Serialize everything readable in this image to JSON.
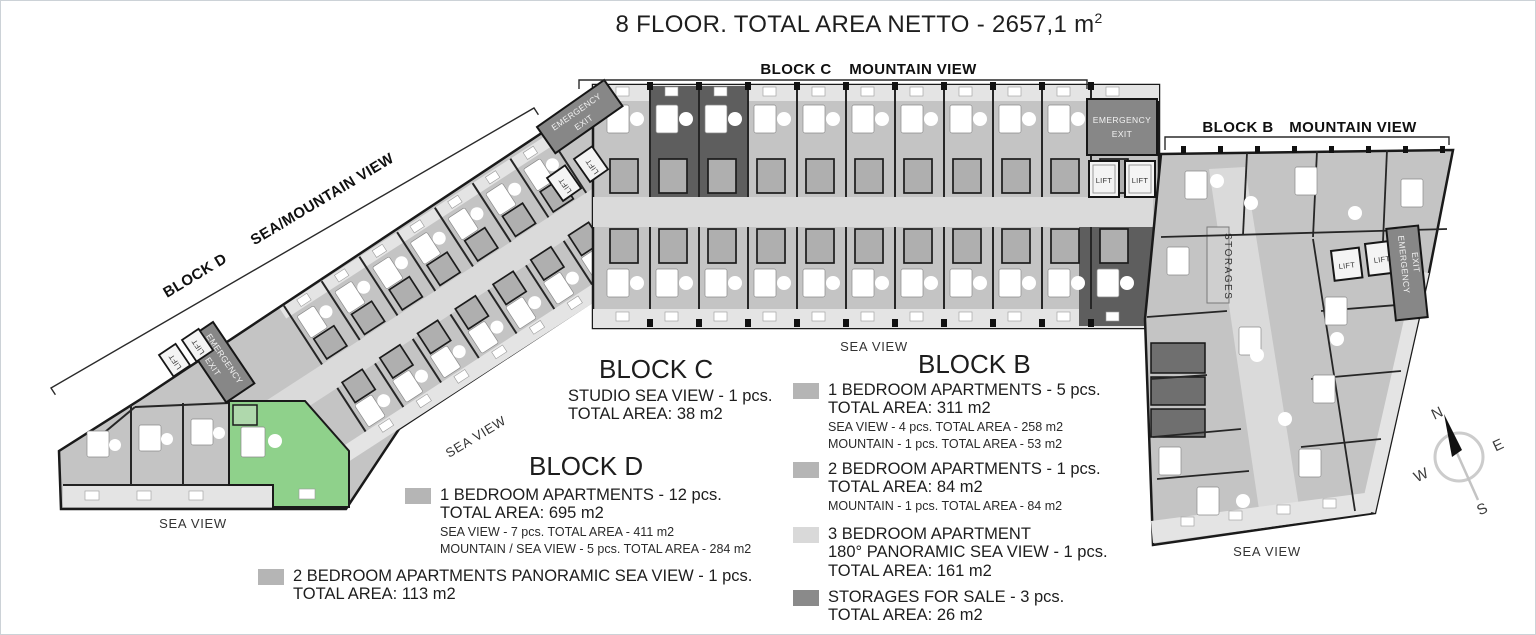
{
  "title": {
    "text": "8 FLOOR. TOTAL AREA NETTO - 2657,1 m",
    "sup": "2"
  },
  "banners": {
    "c": {
      "block": "BLOCK C",
      "view": "MOUNTAIN VIEW"
    },
    "b": {
      "block": "BLOCK B",
      "view": "MOUNTAIN VIEW"
    },
    "d": {
      "block": "BLOCK D",
      "view": "SEA/MOUNTAIN VIEW"
    }
  },
  "plan_labels": {
    "sea_view": "SEA VIEW",
    "storages": "STORAGES",
    "lift": "LIFT",
    "emergency_line1": "EMERGENCY",
    "emergency_line2": "EXIT"
  },
  "compass": {
    "n": "N",
    "e": "E",
    "s": "S",
    "w": "W"
  },
  "legends": {
    "block_c": {
      "heading": "BLOCK C",
      "line1": "STUDIO SEA VIEW - 1 pcs.",
      "line2": "TOTAL AREA: 38 m2"
    },
    "block_d": {
      "heading": "BLOCK D",
      "items": [
        {
          "swatch": "#b5b5b5",
          "main": [
            "1 BEDROOM APARTMENTS - 12 pcs.",
            "TOTAL AREA: 695 m2"
          ],
          "sub": [
            "SEA VIEW - 7 pcs. TOTAL AREA - 411 m2",
            "MOUNTAIN / SEA VIEW - 5 pcs. TOTAL AREA - 284 m2"
          ]
        },
        {
          "swatch": "#b5b5b5",
          "main": [
            "2 BEDROOM APARTMENTS PANORAMIC SEA VIEW - 1 pcs.",
            "TOTAL AREA: 113 m2"
          ],
          "sub": []
        }
      ]
    },
    "block_b": {
      "heading": "BLOCK B",
      "items": [
        {
          "swatch": "#b5b5b5",
          "main": [
            "1 BEDROOM APARTMENTS - 5 pcs.",
            "TOTAL AREA: 311 m2"
          ],
          "sub": [
            "SEA VIEW - 4 pcs. TOTAL AREA - 258 m2",
            "MOUNTAIN - 1 pcs. TOTAL AREA - 53 m2"
          ]
        },
        {
          "swatch": "#b5b5b5",
          "main": [
            "2 BEDROOM APARTMENTS - 1 pcs.",
            "TOTAL AREA: 84 m2"
          ],
          "sub": [
            "MOUNTAIN - 1 pcs. TOTAL AREA - 84 m2"
          ]
        },
        {
          "swatch": "#d9d9d9",
          "main": [
            "3 BEDROOM APARTMENT",
            "180° PANORAMIC SEA VIEW - 1 pcs.",
            "TOTAL AREA: 161 m2"
          ],
          "sub": []
        },
        {
          "swatch": "#8a8a8a",
          "main": [
            "STORAGES FOR SALE - 3 pcs.",
            "TOTAL AREA: 26 m2"
          ],
          "sub": []
        }
      ]
    }
  },
  "palette": {
    "apartment": "#c4c4c4",
    "corridor": "#dadada",
    "balcony": "#e4e4e4",
    "dark_unit": "#5e5e5e",
    "storage": "#6f6f6f",
    "emergency_banner": "#878787",
    "highlight_green": "#8fd18b",
    "wall": "#1a1a1a"
  }
}
